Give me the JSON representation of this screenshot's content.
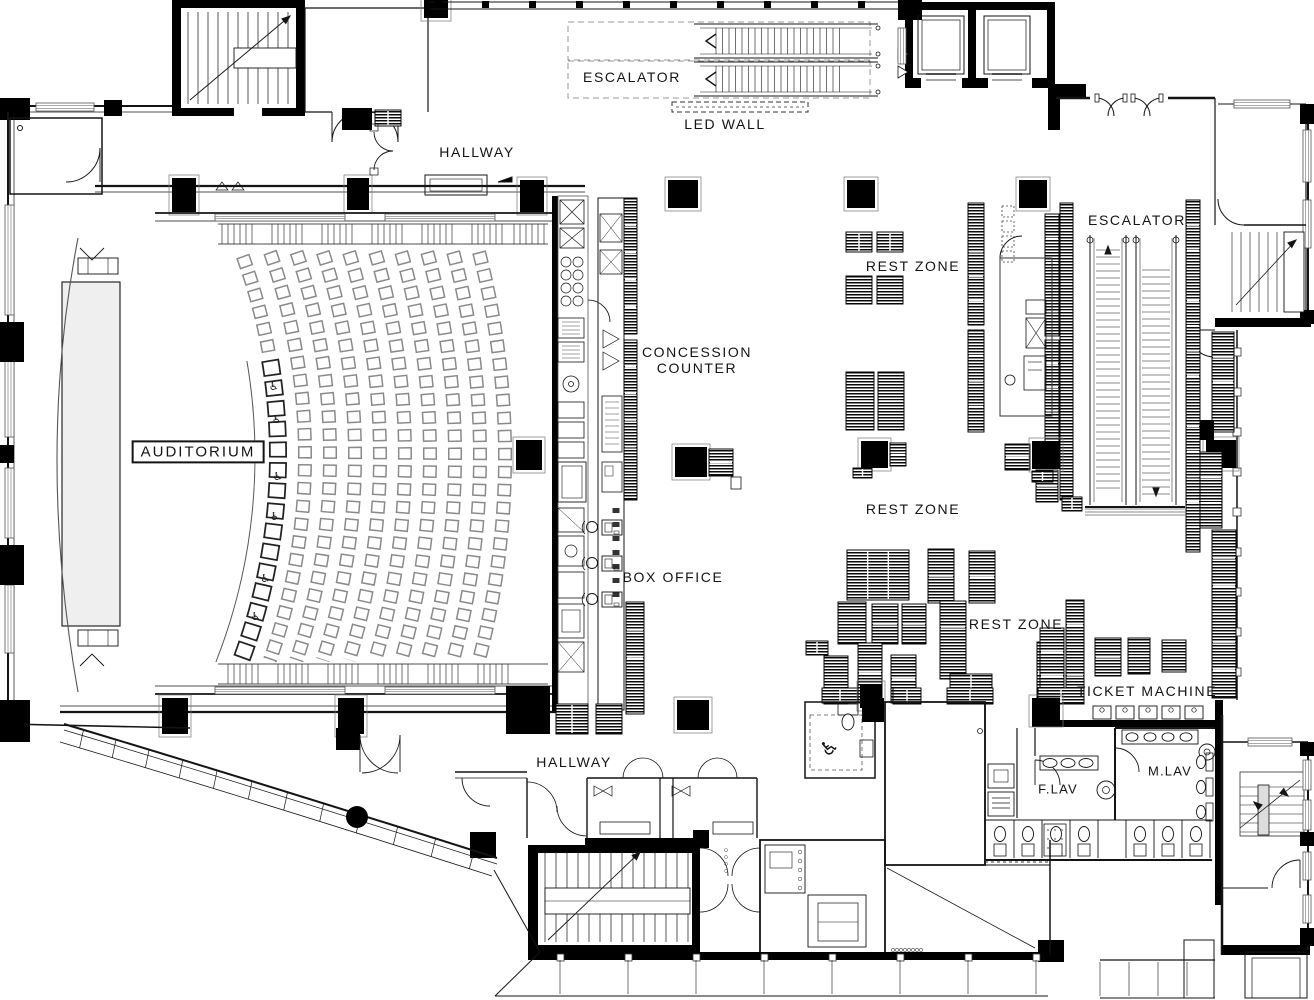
{
  "drawing": {
    "type": "architectural floor plan",
    "description": "Cinema lobby level plan with auditorium, concession, box office, rest zones, escalators and lavatories"
  },
  "labels": {
    "escalator_top": "ESCALATOR",
    "led_wall": "LED WALL",
    "hallway_top": "HALLWAY",
    "escalator_right": "ESCALATOR",
    "rest_zone_1": "REST ZONE",
    "concession_counter": "CONCESSION\nCOUNTER",
    "auditorium": "AUDITORIUM",
    "box_office": "BOX OFFICE",
    "rest_zone_2": "REST ZONE",
    "rest_zone_3": "REST ZONE",
    "ticket_machine": "TICKET MACHINE",
    "f_lav": "F.LAV",
    "m_lav": "M.LAV",
    "hallway_bottom": "HALLWAY"
  },
  "colors": {
    "ink": "#141414",
    "wall": "#000000",
    "seat": "#777777",
    "dash": "#999999",
    "background": "#ffffff"
  }
}
